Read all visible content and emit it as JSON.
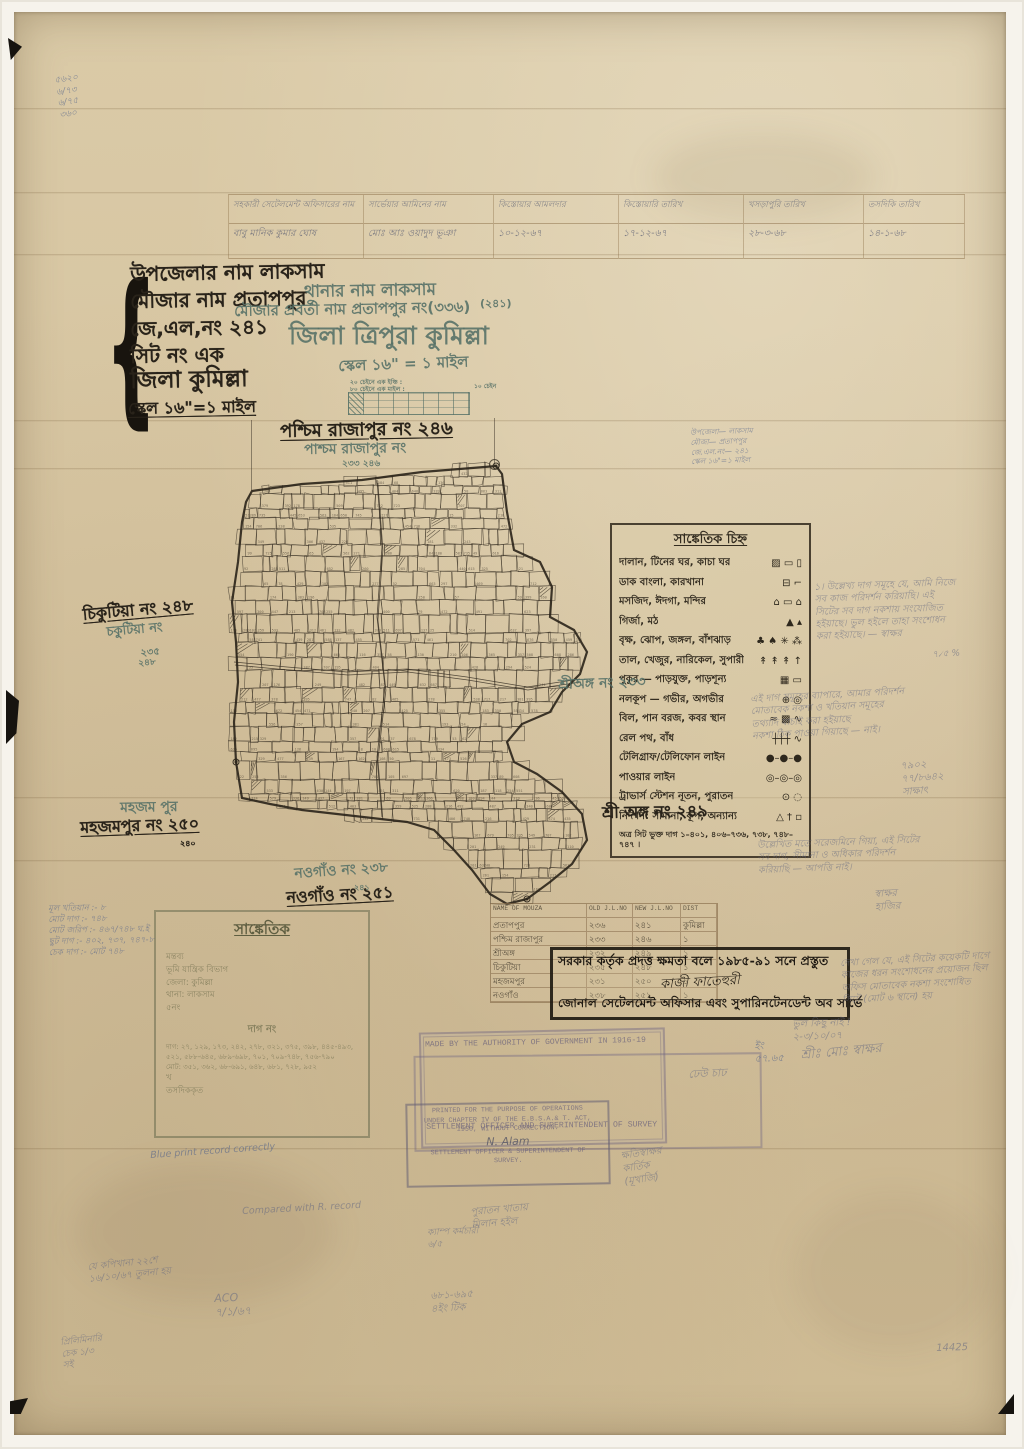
{
  "colors": {
    "paper": "#d8c6a2",
    "ink": "#29231a",
    "teal": "#547066",
    "pencil": "#686a80",
    "stamp_dark": "#1e1912",
    "english_stamp": "#68607c"
  },
  "top_table": {
    "headers": [
      "সহকারী সেটেলমেন্ট অফিসারের নাম",
      "সার্ভেয়ার আমিনের নাম",
      "কিস্তোয়ার আমলদার",
      "কিস্তোয়ারি তারিখ",
      "খসড়াপুরি তারিখ",
      "তসদিকি তারিখ"
    ],
    "row": [
      "বাবু মানিক কুমার ঘোষ",
      "মোঃ আঃ ওয়াদুদ ভূঞা",
      "১০-১২-৬৭",
      "১৭-১২-৬৭",
      "২৮-৩-৬৮",
      "১৪-১-৬৮"
    ]
  },
  "placed_texts": [
    {
      "t": "উপজেলার নাম  লাকসাম",
      "x": 128,
      "y": 261,
      "s": 20,
      "ink": "black",
      "rot": -1
    },
    {
      "t": "মৌজার নাম  প্রতাপপুর",
      "x": 128,
      "y": 288,
      "s": 20,
      "ink": "black",
      "rot": -1
    },
    {
      "t": "জে,এল,নং  ২৪১",
      "x": 128,
      "y": 316,
      "s": 20,
      "ink": "black",
      "rot": -1
    },
    {
      "t": "সিট নং  এক",
      "x": 128,
      "y": 343,
      "s": 20,
      "ink": "black",
      "rot": -1
    },
    {
      "t": "জিলা  কুমিল্লা",
      "x": 128,
      "y": 367,
      "s": 23,
      "ink": "black",
      "rot": -1
    },
    {
      "t": "স্কেল ১৬\"=১ মাইল",
      "x": 126,
      "y": 398,
      "s": 16,
      "ink": "black",
      "rot": -1,
      "u": true
    },
    {
      "t": "থানার নাম  লাকসাম",
      "x": 302,
      "y": 281,
      "s": 17,
      "ink": "teal",
      "rot": -1
    },
    {
      "t": "মৌজার প্রবর্তী নাম  প্রতাপপুর নং(৩৩৬)",
      "x": 232,
      "y": 301,
      "s": 15,
      "ink": "teal",
      "rot": -1
    },
    {
      "t": "(২৪১)",
      "x": 478,
      "y": 296,
      "s": 11,
      "ink": "teal",
      "rot": 0
    },
    {
      "t": "জিলা  ত্রিপুরা  কুমিল্লা",
      "x": 287,
      "y": 320,
      "s": 25,
      "ink": "teal",
      "rot": 0
    },
    {
      "t": "স্কেল ১৬\" = ১ মাইল",
      "x": 336,
      "y": 356,
      "s": 15,
      "ink": "teal",
      "rot": -2
    },
    {
      "t": "২০ চেইনে এক ইঞ্চি :",
      "x": 348,
      "y": 378,
      "s": 6,
      "ink": "teal",
      "rot": 0
    },
    {
      "t": "৮০ চেইনে এক মাইল :",
      "x": 348,
      "y": 385,
      "s": 6,
      "ink": "teal",
      "rot": 0
    },
    {
      "t": "১০ চেইন",
      "x": 472,
      "y": 382,
      "s": 6,
      "ink": "teal",
      "rot": 0
    },
    {
      "t": "পশ্চিম রাজাপুর নং ২৪৬",
      "x": 278,
      "y": 420,
      "s": 18,
      "ink": "black",
      "rot": -1,
      "u": true
    },
    {
      "t": "পাশ্চম রাজাপুর নং",
      "x": 302,
      "y": 441,
      "s": 14,
      "ink": "teal",
      "rot": -1
    },
    {
      "t": "২৩৩  ২৪৬",
      "x": 340,
      "y": 458,
      "s": 9,
      "ink": "teal",
      "rot": 0
    },
    {
      "t": "চিকুটিয়া নং ২৪৮",
      "x": 80,
      "y": 604,
      "s": 16,
      "ink": "black",
      "rot": -5,
      "u": true
    },
    {
      "t": "চকুটিয়া নং",
      "x": 104,
      "y": 624,
      "s": 13,
      "ink": "teal",
      "rot": -5
    },
    {
      "t": "২৩৫",
      "x": 138,
      "y": 646,
      "s": 10,
      "ink": "teal",
      "rot": -5
    },
    {
      "t": "২৪৮",
      "x": 136,
      "y": 658,
      "s": 9,
      "ink": "teal",
      "rot": -5
    },
    {
      "t": "মহজম পুর",
      "x": 118,
      "y": 799,
      "s": 14,
      "ink": "teal",
      "rot": -1
    },
    {
      "t": "মহজমপুর নং ২৫০",
      "x": 78,
      "y": 817,
      "s": 16,
      "ink": "black",
      "rot": -2,
      "u": true
    },
    {
      "t": "২৪০",
      "x": 178,
      "y": 838,
      "s": 8,
      "ink": "black",
      "rot": 0
    },
    {
      "t": "নওগাঁও নং ২৩৮",
      "x": 292,
      "y": 865,
      "s": 14,
      "ink": "teal",
      "rot": -4
    },
    {
      "t": "২৪১",
      "x": 352,
      "y": 882,
      "s": 8,
      "ink": "teal",
      "rot": 0
    },
    {
      "t": "নওগাঁও নং ২৫১",
      "x": 284,
      "y": 887,
      "s": 16,
      "ink": "black",
      "rot": -3,
      "u": true
    },
    {
      "t": "শ্রী অঙ্গ নং ২৪৯",
      "x": 600,
      "y": 802,
      "s": 16,
      "ink": "black",
      "rot": -1
    },
    {
      "t": "শ্রীঅঙ্গ নং ২৩৩",
      "x": 556,
      "y": 676,
      "s": 14,
      "ink": "teal",
      "rot": -2
    }
  ],
  "legend": {
    "title": "সাঙ্কেতিক চিহ্ন",
    "rows": [
      {
        "label": "দালান, টিনের ঘর, কাচা ঘর",
        "symbols": "▨ ▭ ▯"
      },
      {
        "label": "ডাক বাংলা, কারখানা",
        "symbols": "⊟ ⌐"
      },
      {
        "label": "মসজিদ, ঈদগা, মন্দির",
        "symbols": "⌂ ▭ ⌂"
      },
      {
        "label": "গির্জা, মঠ",
        "symbols": "▲ ▴"
      },
      {
        "label": "বৃক্ষ, ঝোপ, জঙ্গল, বাঁশঝাড়",
        "symbols": "♣ ♠ ✳ ⁂"
      },
      {
        "label": "তাল, খেজুর, নারিকেল, সুপারী",
        "symbols": "↟ ↟ ↟ ↑"
      },
      {
        "label": "পুকুর — পাড়যুক্ত, পাড়শূন্য",
        "symbols": "▦ ▭"
      },
      {
        "label": "নলকূপ — গভীর, অগভীর",
        "symbols": "⊕ ◎"
      },
      {
        "label": "বিল, পান বরজ, কবর স্থান",
        "symbols": "≈ ▩ ∿"
      },
      {
        "label": "রেল পথ, বাঁধ",
        "symbols": "┼┼┼ ∿"
      },
      {
        "label": "টেলিগ্রাফ/টেলিফোন লাইন",
        "symbols": "●–●–●"
      },
      {
        "label": "পাওয়ার লাইন",
        "symbols": "◎–◎–◎"
      },
      {
        "label": "ট্রাভার্স স্টেশন নূতন, পুরাতন",
        "symbols": "⊙ ◌"
      },
      {
        "label": "নিদর্শন: সীমানা, কূপ, অন্যান্য",
        "symbols": "△ † ▫"
      }
    ],
    "footer": "অত্র সিট ভুক্ত দাগ ১–৪০১, ৪০৬–৭৩৬, ৭৩৮, ৭৪৮–৭৪৭ ।"
  },
  "mouza_table": {
    "headers": [
      "NAME OF MOUZA",
      "OLD J.L.NO",
      "NEW J.L.NO",
      "DIST"
    ],
    "rows": [
      [
        "প্রতাপপুর",
        "২৩৬",
        "২৪১",
        "কুমিল্লা"
      ],
      [
        "পশ্চিম রাজাপুর",
        "২৩৩",
        "২৪৬",
        "১"
      ],
      [
        "শ্রীঅঙ্গ",
        "২৩২",
        "২৪৯",
        "১"
      ],
      [
        "চিকুটিয়া",
        "২৩৫",
        "২৪৮",
        "১"
      ],
      [
        "মহজমপুর",
        "২৩১",
        "২৫০",
        "১"
      ],
      [
        "নওগাঁও",
        "২৩৮",
        "২৫১",
        "১"
      ]
    ]
  },
  "authority_stamp": {
    "line1": "সরকার কর্তৃক প্রদত্ত ক্ষমতা বলে ১৯৮৫-৯১ সনে প্রস্তুত",
    "signature": "কাজী ফাতেহুরী",
    "line2": "জোনাল সেটেলমেন্ট অফিসার এবং সুপারিনটেনডেন্ট অব সার্ভে"
  },
  "ref_box": {
    "title": "সাঙ্কেতিক",
    "head_lines": [
      "মন্তব্য",
      "ভূমি যান্ত্রিক বিভাগ",
      "জেলা: কুমিল্লা",
      "থানা: লাকসাম",
      "৫নং"
    ],
    "dag_label": "দাগ নং",
    "dag_lines": [
      "দাগ: ২৭, ১২৯, ১৭৩, ২৪২, ২৭৮, ৩২১, ৩৭৫, ৩৯৮, ৪৪৫-৪৯৩, ৫২১, ৫৮৮-৬৪৫, ৬৮৯-৬৯৮, ৭০১, ৭০৯-৭৪৮, ৭৫৬-৭৯০",
      "মোট: ৩৫১, ৩৬২, ৬৮-৬৯১, ৬৪৮, ৬৮১, ৭২৮, ৯৫২"
    ],
    "extra_lines": [
      "খ",
      "তসদিককৃত"
    ]
  },
  "english_stamps": {
    "a1": "MADE BY THE AUTHORITY OF GOVERNMENT IN 1916-19",
    "a2": "SETTLEMENT OFFICER AND SUPERINTENDENT OF SURVEY",
    "b_lines": [
      "PRINTED FOR THE PURPOSE OF OPERATIONS",
      "UNDER CHAPTER IV OF THE E.B.S.A.& T. ACT,",
      "1950, WITHOUT CORRECTION."
    ],
    "b_sig": "N. Alam",
    "b_lines2": [
      "SETTLEMENT OFFICER & SUPERINTENDENT OF",
      "SURVEY."
    ]
  },
  "pencil_notes": [
    {
      "x": 52,
      "y": 74,
      "rot": -8,
      "s": 9,
      "c": "blue",
      "lines": [
        "৫৬২০",
        "৬/৭৩",
        "৬/৭৫",
        "৩৬০"
      ]
    },
    {
      "x": 688,
      "y": 426,
      "rot": -2,
      "s": 7.5,
      "c": "blue",
      "lines": [
        "উপজেলা— লাকসাম",
        "মৌজা— প্রতাপপুর",
        "জে.এল.নং— ২৪১",
        "স্কেল ১৬\"=১ মাইল"
      ]
    },
    {
      "x": 812,
      "y": 580,
      "rot": -2,
      "s": 9.5,
      "c": "gray",
      "lines": [
        "১। উল্লেখ্য দাগ সমূহে যে, আমি নিজে",
        "সব কাজ পরিদর্শন করিয়াছি। এই",
        "সিটের সব দাগ নকশায় সংযোজিত",
        "হইয়াছে। ভুল হইলে তাহা সংশোধন",
        "করা হইয়াছে। — স্বাক্ষর"
      ]
    },
    {
      "x": 930,
      "y": 648,
      "rot": -3,
      "s": 9,
      "c": "gray",
      "lines": [
        "৭৴৫ %"
      ]
    },
    {
      "x": 748,
      "y": 692,
      "rot": -3,
      "s": 9.5,
      "c": "gray",
      "lines": [
        "এই দাগ সমূহের ব্যাপারে, আমার পরিদর্শন",
        "মোতাবেক নকশা ও খতিয়ান সমূহের",
        "তথ্যাদি যাচাই করা হইয়াছে",
        "নকশা ঠিক পাওয়া গিয়াছে — নাই।"
      ]
    },
    {
      "x": 898,
      "y": 758,
      "rot": -4,
      "s": 10,
      "c": "gray",
      "lines": [
        "৭৯০২",
        "৭৭/৮৬৪২",
        "সাক্ষাৎ"
      ]
    },
    {
      "x": 755,
      "y": 838,
      "rot": -2,
      "s": 9.5,
      "c": "gray",
      "lines": [
        "উল্লেখিত মতে সরেজমিনে গিয়া, এই সিটের",
        "সব দাগ, সীমানা ও অধিকার পরিদর্শন",
        "করিয়াছি — আপত্তি নাই।"
      ]
    },
    {
      "x": 872,
      "y": 886,
      "rot": -3,
      "s": 10,
      "c": "gray",
      "lines": [
        "স্বাক্ষর",
        "হাজির"
      ]
    },
    {
      "x": 46,
      "y": 902,
      "rot": -1,
      "s": 8.5,
      "c": "blue",
      "lines": [
        "মূল খতিয়ান :- ৮",
        "মোট দাগ :- ৭৪৮",
        "মোট জরিপ :- ৪৬৭/৭৪৮ ঘ.ই",
        "ছুট দাগ :- ৪০২, ৭৩৭, ৭৪৭-৮",
        "চেক দাগ :- মোট ৭৪৮"
      ]
    },
    {
      "x": 838,
      "y": 956,
      "rot": -3,
      "s": 9.5,
      "c": "gray",
      "lines": [
        "দেখা গেল যে, এই সিটের কয়েকটি দাগে",
        "কাজের ধরন সংশোধনের প্রয়োজন ছিল",
        "অফিস মোতাবেক নকশা সংশোধিত",
        "সিটে (মোট ৬ স্থানে) হয়"
      ]
    },
    {
      "x": 790,
      "y": 1016,
      "rot": -2,
      "s": 10,
      "c": "gray",
      "lines": [
        "ভুল কিছু নাই !",
        "২-৩/১০/০৭"
      ]
    },
    {
      "x": 798,
      "y": 1046,
      "rot": -5,
      "s": 13,
      "c": "gray",
      "lines": [
        "শ্রীঃ মোঃ স্বাক্ষর"
      ]
    },
    {
      "x": 752,
      "y": 1038,
      "rot": -2,
      "s": 10,
      "c": "blue",
      "lines": [
        "ইং",
        "৫৭.৬৫"
      ]
    },
    {
      "x": 686,
      "y": 1066,
      "rot": -3,
      "s": 11,
      "c": "gray",
      "lines": [
        "ঢেউ চাঢ"
      ]
    },
    {
      "x": 618,
      "y": 1148,
      "rot": -8,
      "s": 10,
      "c": "gray",
      "lines": [
        "ক্ষতিস্বাক্ষর",
        "কার্তিক",
        "(মূখার্জি)"
      ]
    },
    {
      "x": 468,
      "y": 1204,
      "rot": -5,
      "s": 10,
      "c": "gray",
      "lines": [
        "পুরাতন খাতায়",
        "মিলান হইল"
      ]
    },
    {
      "x": 148,
      "y": 1148,
      "rot": -4,
      "s": 9.5,
      "c": "blue",
      "lines": [
        "Blue print record correctly"
      ]
    },
    {
      "x": 240,
      "y": 1204,
      "rot": -3,
      "s": 9.5,
      "c": "gray",
      "lines": [
        "Compared with R. record"
      ]
    },
    {
      "x": 85,
      "y": 1260,
      "rot": -6,
      "s": 9.5,
      "c": "gray",
      "lines": [
        "যে কপিখানা ২২শে",
        "১৬/১০/৬৭ তুলনা হয়"
      ]
    },
    {
      "x": 212,
      "y": 1290,
      "rot": -3,
      "s": 11,
      "c": "gray",
      "lines": [
        "ACO",
        "৭/১/৬৭"
      ]
    },
    {
      "x": 425,
      "y": 1226,
      "rot": -2,
      "s": 9,
      "c": "gray",
      "lines": [
        "ক্যাম্প কর্মচারী",
        "৬/৫"
      ]
    },
    {
      "x": 428,
      "y": 1288,
      "rot": -3,
      "s": 10,
      "c": "gray",
      "lines": [
        "৬৮১-৬৯৫",
        "৪ইং টিক"
      ]
    },
    {
      "x": 58,
      "y": 1336,
      "rot": -6,
      "s": 9,
      "c": "gray",
      "lines": [
        "প্রিলিমিনারি",
        "চেক ১/৩",
        "সই"
      ]
    },
    {
      "x": 934,
      "y": 1340,
      "rot": -2,
      "s": 10,
      "c": "gray",
      "lines": [
        "14425"
      ]
    }
  ]
}
